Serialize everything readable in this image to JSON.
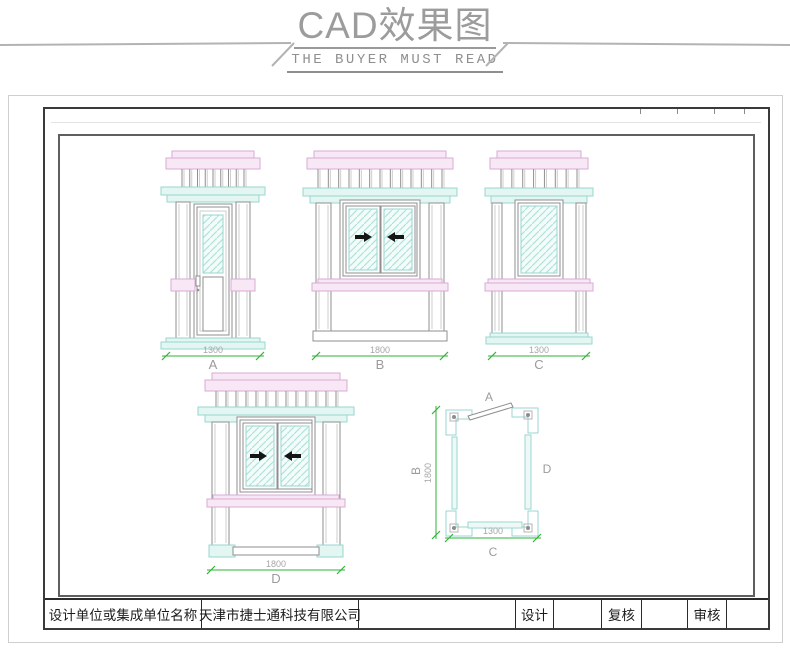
{
  "header": {
    "title": "CAD效果图",
    "subtitle": "THE BUYER MUST READ"
  },
  "views": {
    "a": {
      "label": "A",
      "dimension": "1300"
    },
    "b": {
      "label": "B",
      "dimension": "1800"
    },
    "c": {
      "label": "C",
      "dimension": "1300"
    },
    "d": {
      "label": "D",
      "dimension": "1800"
    }
  },
  "plan": {
    "labels": {
      "top": "A",
      "left": "B",
      "bottom": "C",
      "right": "D"
    },
    "dims": {
      "width": "1300",
      "height": "1800"
    }
  },
  "title_block": {
    "company_label": "设计单位或集成单位名称",
    "company_name": "天津市捷士通科技有限公司",
    "design_label": "设计",
    "review_label": "复核",
    "audit_label": "审核"
  },
  "colors": {
    "pink": "#f8e8f6",
    "pink_border": "#d9abd4",
    "cyan": "#e3f6f2",
    "cyan_border": "#99d6cf",
    "wall": "#eef9f7",
    "line": "#8f8f8f",
    "line_light": "#cecece",
    "dim_green": "#2fb335",
    "dim_text": "#a6a6a6",
    "label_gray": "#9b9b9b",
    "arrow_black": "#151515",
    "header_gray": "#9c9c9c"
  }
}
